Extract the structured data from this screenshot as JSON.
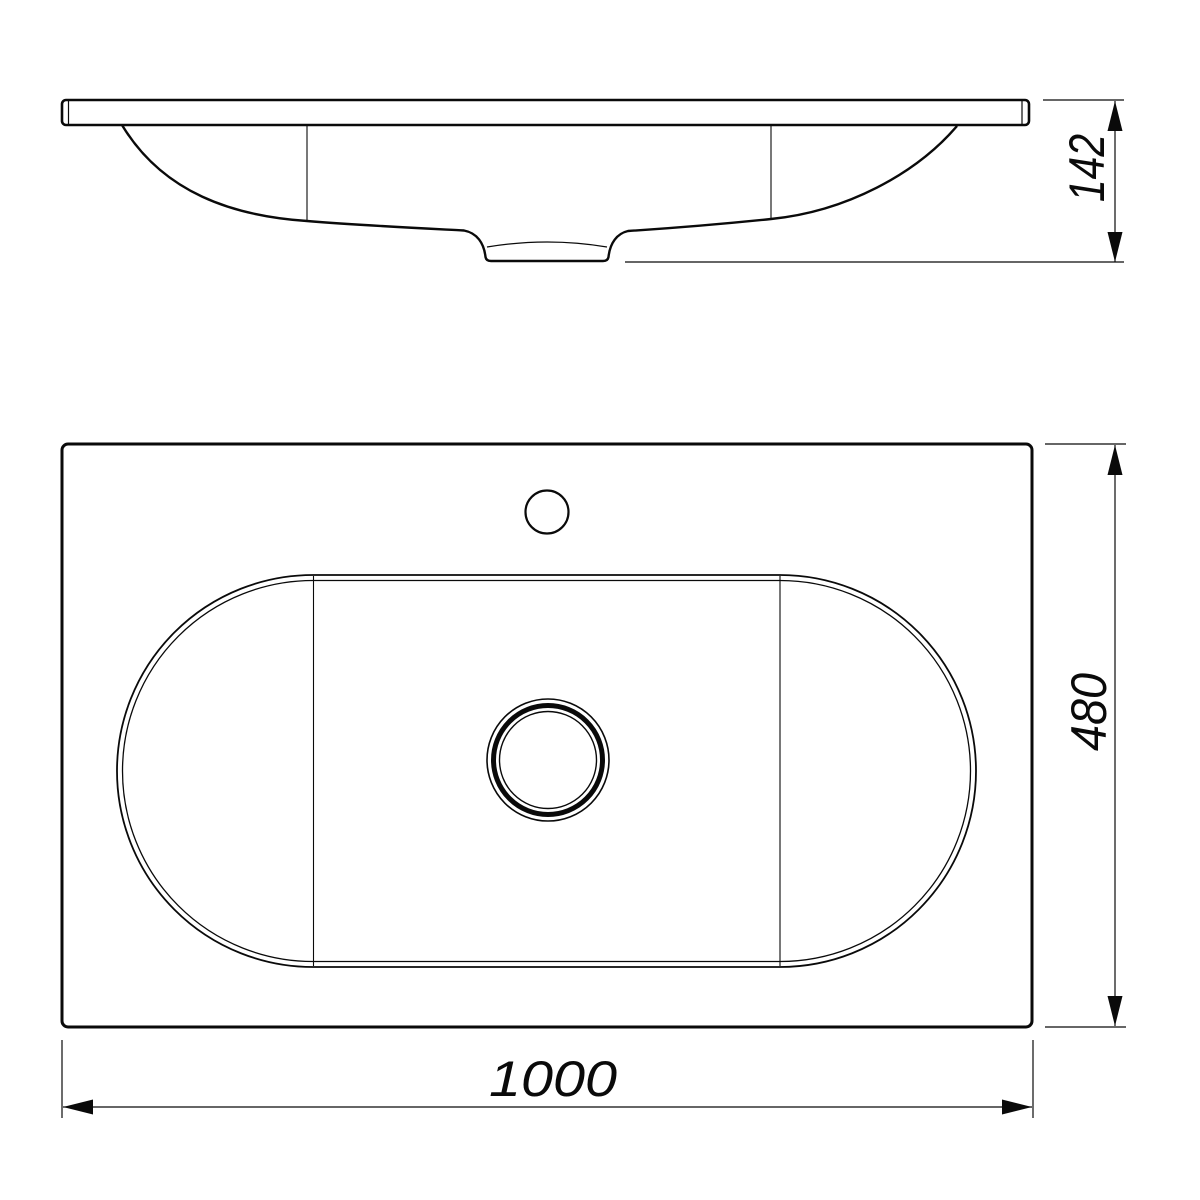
{
  "colors": {
    "line": "#0a0a0a",
    "background": "#ffffff"
  },
  "dimensions": {
    "front_height": "142",
    "plan_width": "1000",
    "plan_depth": "480"
  }
}
